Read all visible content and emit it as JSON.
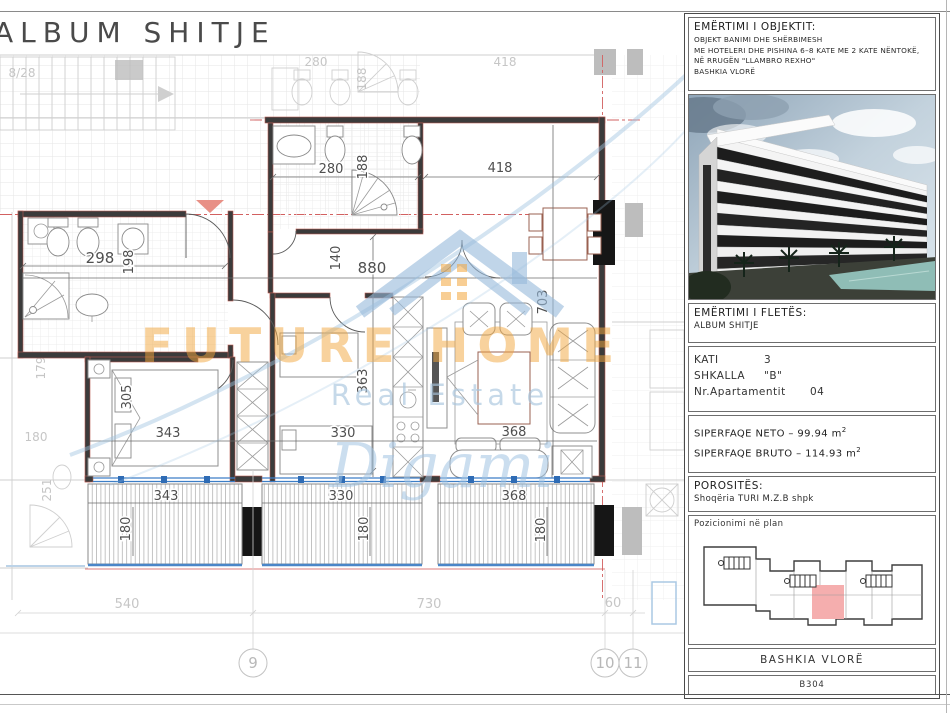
{
  "plan": {
    "title": "ALBUM SHITJE",
    "stair_label": "8/28",
    "grid_bubbles": [
      "9",
      "10",
      "11"
    ],
    "dims": {
      "bath_top_w": "280",
      "bath_top_h": "188",
      "living_top_w": "418",
      "bath_left_w": "298",
      "bath_left_h": "198",
      "hall_h": "140",
      "total_w": "880",
      "living_h": "703",
      "bed1_h": "305",
      "bed1_w": "343",
      "bed2_w": "330",
      "bed2_h": "363",
      "living_w": "368",
      "balc_left_w": "343",
      "balc_left_h": "180",
      "balc_mid_w": "330",
      "balc_mid_h": "180",
      "balc_right_w": "368",
      "balc_right_h": "180",
      "base_left": "540",
      "base_mid": "730",
      "base_right": "60",
      "faded_top_w": "418",
      "faded_bath_w": "280",
      "faded_bath_h": "188",
      "faded_left_a": "179",
      "faded_left_b": "180",
      "faded_left_c": "251"
    }
  },
  "watermark": {
    "brand": "FUTURE HOME",
    "tagline": "Real Estate",
    "signature": "Digami"
  },
  "title_block": {
    "object": {
      "label": "EMËRTIMI I OBJEKTIT:",
      "line1": "OBJEKT BANIMI DHE SHËRBIMESH",
      "line2": "ME HOTELERI DHE PISHINA 6–8 KATE ME 2 KATE NËNTOKË,",
      "line3": "NË RRUGËN \"LLAMBRO REXHO\"",
      "line4": "BASHKIA VLORË"
    },
    "sheet": {
      "label": "EMËRTIMI I FLETËS:",
      "value": "ALBUM SHITJE"
    },
    "unit": {
      "floor_label": "KATI",
      "floor_value": "3",
      "stair_label": "SHKALLA",
      "stair_value": "\"B\"",
      "apt_label": "Nr.Apartamentit",
      "apt_value": "04"
    },
    "areas": {
      "neto_text": "SIPERFAQE NETO  –  99.94  m",
      "bruto_text": "SIPERFAQE BRUTO  –  114.93  m",
      "sup": "2"
    },
    "client": {
      "label": "POROSITËS:",
      "value": "Shoqëria  TURI  M.Z.B  shpk"
    },
    "position": {
      "label": "Pozicionimi në plan"
    },
    "municipality": "BASHKIA  VLORË",
    "sheet_code": "B304"
  }
}
